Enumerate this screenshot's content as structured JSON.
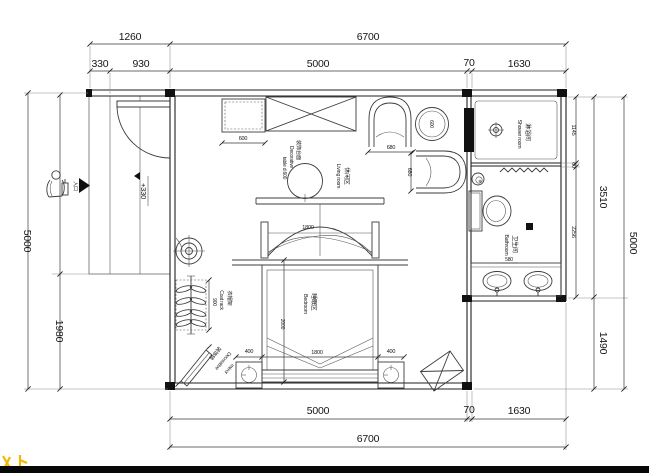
{
  "dimensions": {
    "top": {
      "balcony": "1260",
      "overall": "6700",
      "s330": "330",
      "s930": "930",
      "s5000": "5000",
      "s70": "70",
      "s1630": "1630"
    },
    "bottom": {
      "s5000": "5000",
      "s70": "70",
      "s1630": "1630",
      "overall": "6700"
    },
    "left": {
      "overall": "5000",
      "lower": "1980"
    },
    "right": {
      "s1145": "1145",
      "s60": "60",
      "s2256": "2256",
      "upper": "3510",
      "lower": "1490",
      "overall": "5000"
    },
    "interior": {
      "cabinet": "600",
      "side_table": "600",
      "chair_w": "680",
      "chair_d": "680",
      "canopy": "1800",
      "bed_length": "2000",
      "bed_width": "1800",
      "stool_left": "400",
      "stool_right": "400",
      "coat_rack": "900",
      "wc": "580"
    }
  },
  "labels": {
    "living": {
      "zh": "休闲区",
      "en": "Living room"
    },
    "bedroom": {
      "zh": "睡眠区",
      "en": "Bedroom"
    },
    "shower": {
      "zh": "淋浴间",
      "en": "Shower room"
    },
    "bathroom": {
      "zh": "卫生间",
      "en": "Bathroom"
    },
    "decor_table": {
      "zh": "装饰台面",
      "en1": "Decorative",
      "en2": "table d.600"
    },
    "coat_rack": {
      "zh": "衣帽架",
      "en": "Coat rack"
    },
    "mirror": {
      "zh": "装饰镜",
      "en1": "Decorative",
      "en2": "mirror"
    },
    "entrance": {
      "zh": "入口"
    },
    "level": {
      "value": "+330"
    }
  },
  "colors": {
    "line": "#1f1f1f",
    "dim_text": "#161616",
    "hatch": "#c4c4c4",
    "accent_yellow": "#f2b705",
    "footer_bar": "#070707"
  }
}
